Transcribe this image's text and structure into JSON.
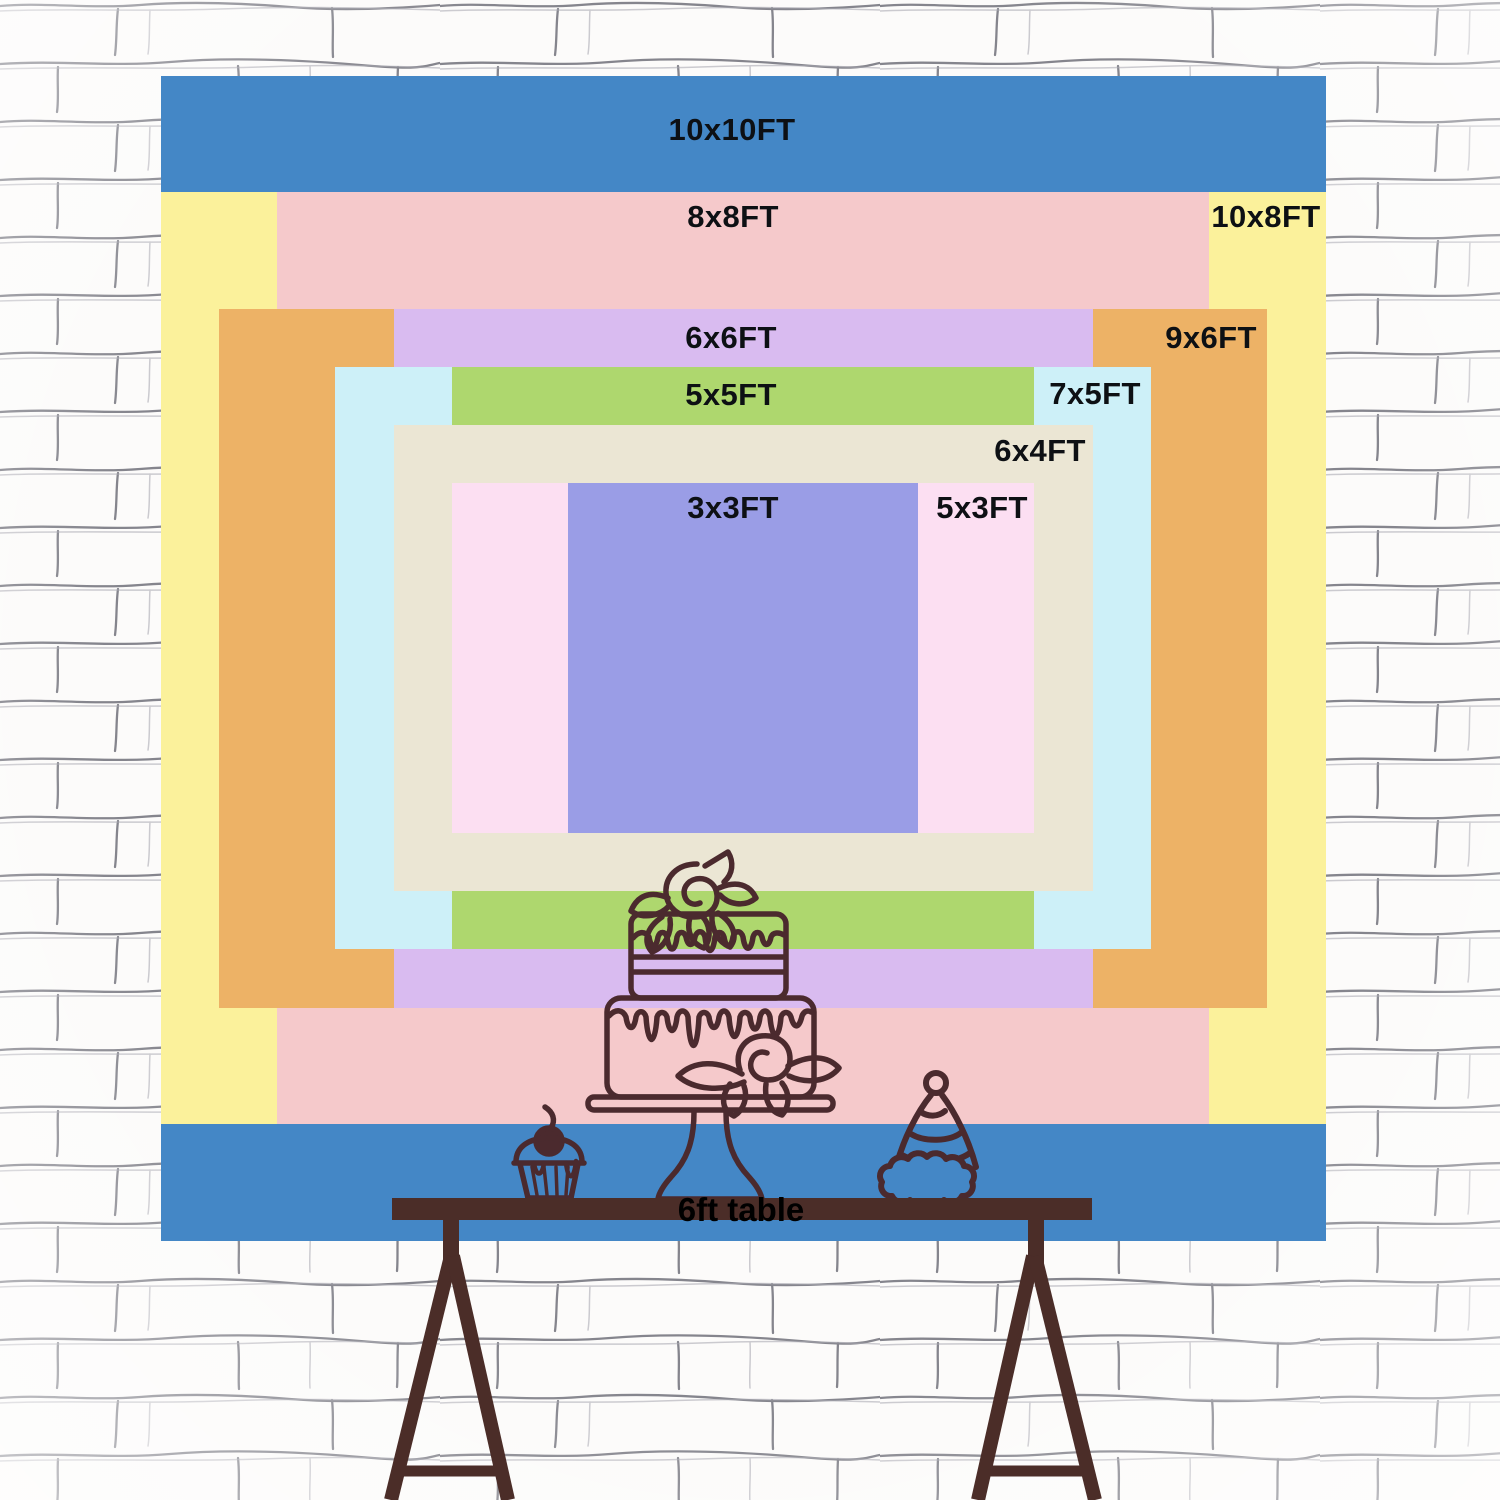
{
  "backdrop": {
    "px_per_ft": 116.5,
    "center_x": 743,
    "center_y": 658,
    "label_color": "#0d1014",
    "layers": [
      {
        "label": "10x10FT",
        "width_ft": 10,
        "height_ft": 10,
        "color": "#4487c6",
        "label_cx": 732,
        "label_cy": 130
      },
      {
        "label": "10x8FT",
        "width_ft": 10,
        "height_ft": 8,
        "color": "#fbf19b",
        "label_cx": 1266,
        "label_cy": 217
      },
      {
        "label": "8x8FT",
        "width_ft": 8,
        "height_ft": 8,
        "color": "#f5c9cb",
        "label_cx": 733,
        "label_cy": 217
      },
      {
        "label": "9x6FT",
        "width_ft": 9,
        "height_ft": 6,
        "color": "#edb266",
        "label_cx": 1211,
        "label_cy": 338
      },
      {
        "label": "6x6FT",
        "width_ft": 6,
        "height_ft": 6,
        "color": "#d9bbf0",
        "label_cx": 731,
        "label_cy": 338
      },
      {
        "label": "7x5FT",
        "width_ft": 7,
        "height_ft": 5,
        "color": "#cdf0f8",
        "label_cx": 1095,
        "label_cy": 394
      },
      {
        "label": "5x5FT",
        "width_ft": 5,
        "height_ft": 5,
        "color": "#aed76e",
        "label_cx": 731,
        "label_cy": 395
      },
      {
        "label": "6x4FT",
        "width_ft": 6,
        "height_ft": 4,
        "color": "#ebe6d4",
        "label_cx": 1040,
        "label_cy": 451
      },
      {
        "label": "5x3FT",
        "width_ft": 5,
        "height_ft": 3,
        "color": "#fcdff2",
        "label_cx": 982,
        "label_cy": 508
      },
      {
        "label": "3x3FT",
        "width_ft": 3,
        "height_ft": 3,
        "color": "#9a9de6",
        "label_cx": 733,
        "label_cy": 508
      }
    ]
  },
  "table": {
    "label": "6ft table",
    "color": "#4b2d28",
    "label_color": "#000000"
  },
  "illustration": {
    "line_color": "#4b2a2e",
    "items": [
      "two-tier-cake-on-stand",
      "cupcake-with-cherry",
      "party-hat"
    ]
  },
  "wall": {
    "background": "#fcfbfa",
    "mortar_line_color": "#5d5d68"
  }
}
